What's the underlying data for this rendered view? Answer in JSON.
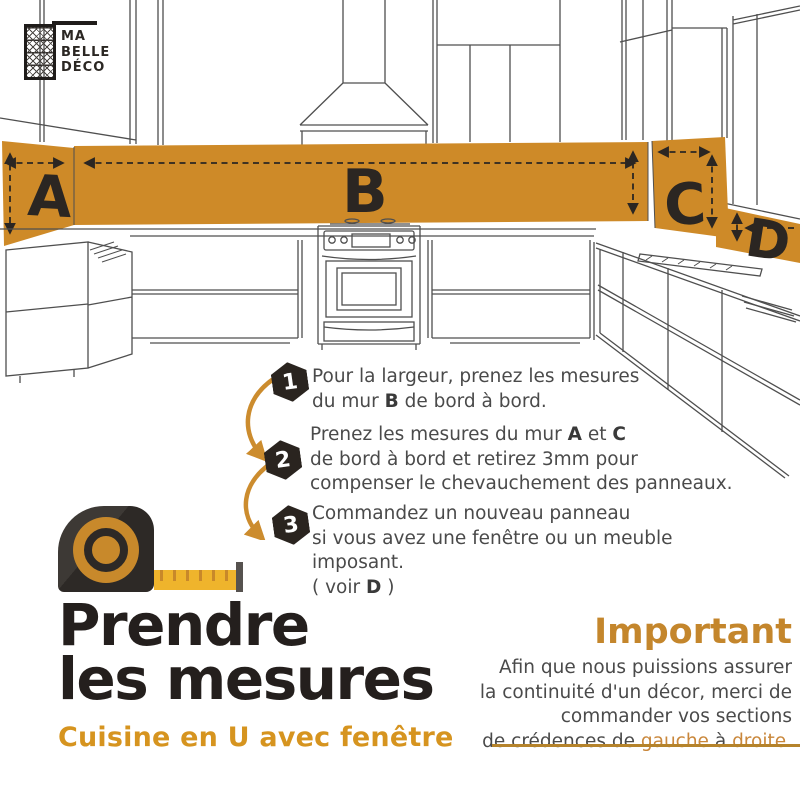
{
  "logo": {
    "line1": "MA",
    "line2": "BELLE",
    "line3": "DÉCO"
  },
  "diagram": {
    "labels": {
      "a": "A",
      "b": "B",
      "c": "C",
      "d": "D"
    }
  },
  "steps": [
    {
      "num": "1",
      "segments": [
        {
          "text": "Pour la largeur, prenez les mesures\ndu mur "
        },
        {
          "text": "B",
          "bold": true
        },
        {
          "text": " de bord à bord."
        }
      ]
    },
    {
      "num": "2",
      "segments": [
        {
          "text": "Prenez les mesures du mur "
        },
        {
          "text": "A",
          "bold": true
        },
        {
          "text": " et "
        },
        {
          "text": "C",
          "bold": true
        },
        {
          "text": "\nde bord à bord et retirez 3mm pour\ncompenser le chevauchement des panneaux."
        }
      ]
    },
    {
      "num": "3",
      "segments": [
        {
          "text": "Commandez un nouveau panneau\nsi vous avez une fenêtre ou un meuble imposant.\n( voir "
        },
        {
          "text": "D",
          "bold": true
        },
        {
          "text": " )"
        }
      ]
    }
  ],
  "title": {
    "line1": "Prendre",
    "line2": "les mesures",
    "subtitle": "Cuisine en U avec fenêtre"
  },
  "important": {
    "heading": "Important",
    "segments": [
      {
        "text": "Afin que nous puissions assurer\nla continuité d'un décor, merci de\ncommander vos sections\nde crédences de "
      },
      {
        "text": "gauche",
        "orange": true
      },
      {
        "text": " à "
      },
      {
        "text": "droite",
        "orange": true
      },
      {
        "text": "."
      }
    ]
  },
  "colors": {
    "band_orange": "#CE8A28",
    "accent_orange": "#CC8C2E",
    "subtitle_orange": "#D6941F",
    "heading_orange": "#C4862C",
    "rule_gold": "#B5832B",
    "tape_yellow": "#EFB42C",
    "dark": "#2B2622",
    "body_text": "#4A4A4A"
  }
}
